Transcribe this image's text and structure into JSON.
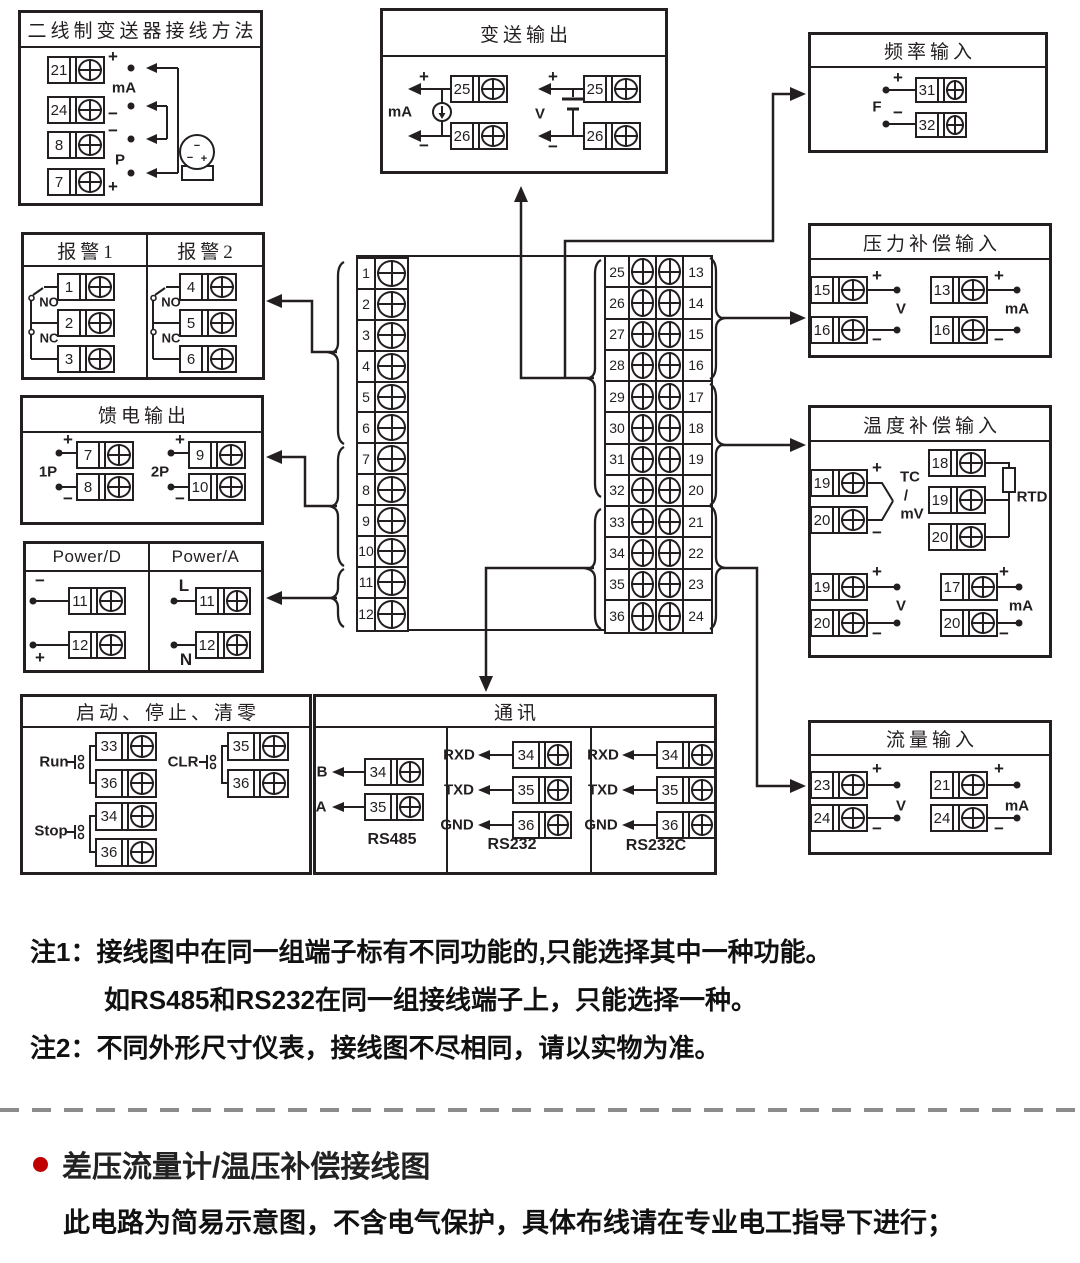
{
  "colors": {
    "line": "#231f20",
    "accent_red": "#c00000",
    "dash_gray": "#8c8c8c",
    "background": "#ffffff"
  },
  "boxes": {
    "two_wire": {
      "title": "二线制变送器接线方法",
      "terms": [
        "21",
        "24",
        "8",
        "7"
      ],
      "plus_top": "+",
      "ma": "mA",
      "minus_mid": "−",
      "minus_low": "−",
      "p": "P",
      "plus_bottom": "+"
    },
    "transmit": {
      "title": "变送输出",
      "ma": {
        "plus": "+",
        "label": "mA",
        "minus": "−",
        "terms": [
          "25",
          "26"
        ]
      },
      "v": {
        "plus": "+",
        "label": "V",
        "minus": "−",
        "terms": [
          "25",
          "26"
        ]
      }
    },
    "freq": {
      "title": "频率输入",
      "plus": "+",
      "label": "F",
      "minus": "−",
      "terms": [
        "31",
        "32"
      ]
    },
    "alarm": {
      "title1": "报警1",
      "title2": "报警2",
      "no": "NO",
      "nc": "NC",
      "terms1": [
        "1",
        "2",
        "3"
      ],
      "terms2": [
        "4",
        "5",
        "6"
      ]
    },
    "feed": {
      "title": "馈电输出",
      "plus": "+",
      "minus": "−",
      "g1": {
        "label": "1P",
        "terms": [
          "7",
          "8"
        ]
      },
      "g2": {
        "label": "2P",
        "terms": [
          "9",
          "10"
        ]
      }
    },
    "power": {
      "title_d": "Power/D",
      "title_a": "Power/A",
      "d": {
        "top": "−",
        "bottom": "+",
        "terms": [
          "11",
          "12"
        ]
      },
      "a": {
        "top": "L",
        "bottom": "N",
        "terms": [
          "11",
          "12"
        ]
      }
    },
    "center": {
      "left": [
        "1",
        "2",
        "3",
        "4",
        "5",
        "6",
        "7",
        "8",
        "9",
        "10",
        "11",
        "12"
      ],
      "right_inner": [
        "25",
        "26",
        "27",
        "28",
        "29",
        "30",
        "31",
        "32",
        "33",
        "34",
        "35",
        "36"
      ],
      "right_outer": [
        "13",
        "14",
        "15",
        "16",
        "17",
        "18",
        "19",
        "20",
        "21",
        "22",
        "23",
        "24"
      ]
    },
    "pressure": {
      "title": "压力补偿输入",
      "plus": "+",
      "minus": "−",
      "v": {
        "label": "V",
        "terms": [
          "15",
          "16"
        ]
      },
      "ma": {
        "label": "mA",
        "terms": [
          "13",
          "16"
        ]
      }
    },
    "temp": {
      "title": "温度补偿输入",
      "plus": "+",
      "minus": "−",
      "tc": {
        "label1": "TC",
        "slash": "/",
        "label2": "mV",
        "terms": [
          "19",
          "20"
        ]
      },
      "rtd": {
        "label": "RTD",
        "terms": [
          "18",
          "19",
          "20"
        ]
      },
      "v": {
        "label": "V",
        "terms": [
          "19",
          "20"
        ]
      },
      "ma": {
        "label": "mA",
        "terms": [
          "17",
          "20"
        ]
      }
    },
    "flow": {
      "title": "流量输入",
      "plus": "+",
      "minus": "−",
      "v": {
        "label": "V",
        "terms": [
          "23",
          "24"
        ]
      },
      "ma": {
        "label": "mA",
        "terms": [
          "21",
          "24"
        ]
      }
    },
    "runstop": {
      "title": "启动、停止、清零",
      "run": {
        "label": "Run",
        "terms": [
          "33",
          "36"
        ]
      },
      "stop": {
        "label": "Stop",
        "terms": [
          "34",
          "36"
        ]
      },
      "clr": {
        "label": "CLR",
        "terms": [
          "35",
          "36"
        ]
      }
    },
    "comm": {
      "title": "通讯",
      "rs485": {
        "label": "RS485",
        "pins": [
          "B",
          "A"
        ],
        "terms": [
          "34",
          "35"
        ]
      },
      "rs232": {
        "label": "RS232",
        "pins": [
          "RXD",
          "TXD",
          "GND"
        ],
        "terms": [
          "34",
          "35",
          "36"
        ]
      },
      "rs232c": {
        "label": "RS232C",
        "pins": [
          "RXD",
          "TXD",
          "GND"
        ],
        "terms": [
          "34",
          "35",
          "36"
        ]
      }
    }
  },
  "notes": {
    "note1": "注1：接线图中在同一组端子标有不同功能的,只能选择其中一种功能。",
    "note1b": "如RS485和RS232在同一组接线端子上，只能选择一种。",
    "note2": "注2：不同外形尺寸仪表，接线图不尽相同，请以实物为准。"
  },
  "footer": {
    "heading": "差压流量计/温压补偿接线图",
    "subheading": "此电路为简易示意图，不含电气保护，具体布线请在专业电工指导下进行；"
  }
}
